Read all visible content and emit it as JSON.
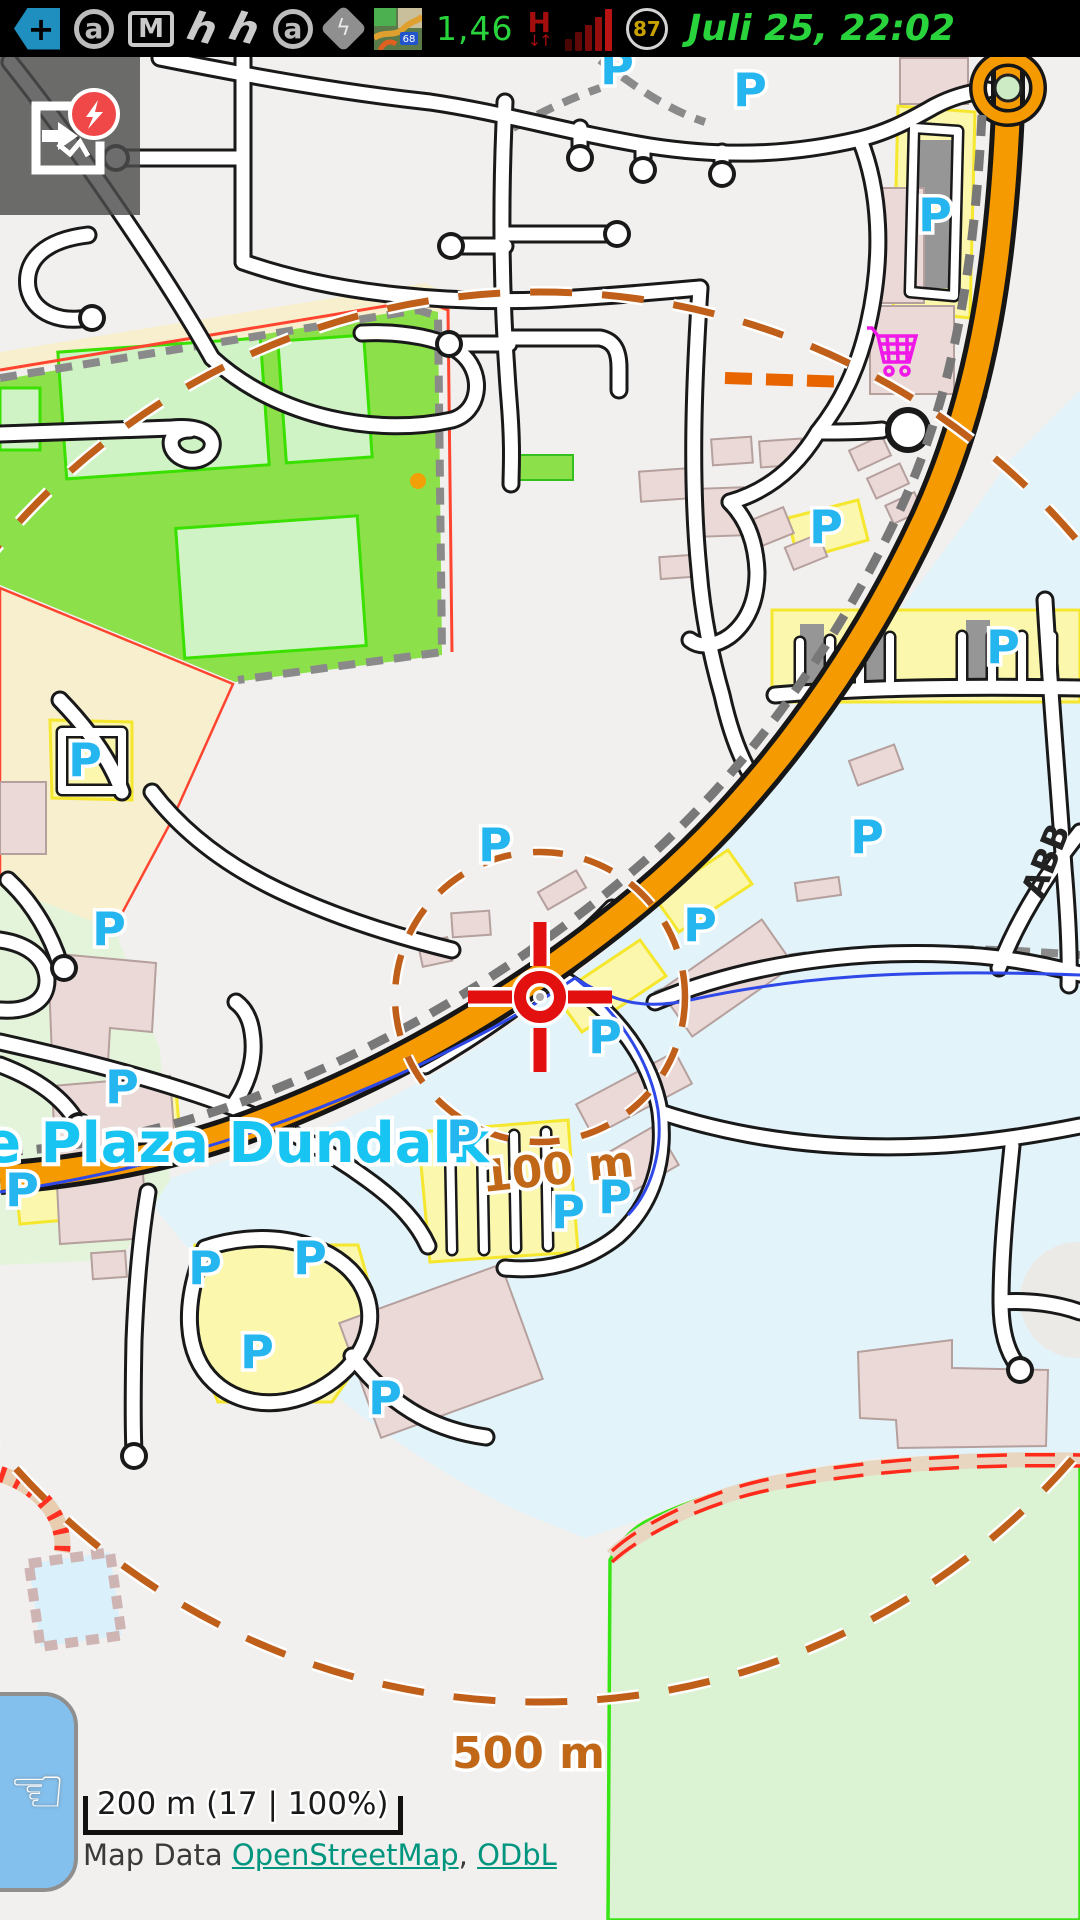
{
  "status_bar": {
    "icons": [
      "back-arrow-plus",
      "app-circle-a",
      "gmail",
      "app-h",
      "app-h-2",
      "app-circle-a-2",
      "navigation-diamond",
      "minimap"
    ],
    "data_value": "1,46",
    "network_mode": "H",
    "battery_percent": "87",
    "datetime": "Juli 25, 22:02"
  },
  "map": {
    "place_label": "The Plaza Dundalk",
    "ring_100": "100 m",
    "ring_500": "500 m",
    "street_label": "ABB",
    "parking_symbol": "P",
    "parking_markers": [
      [
        617,
        68
      ],
      [
        750,
        90
      ],
      [
        935,
        215
      ],
      [
        826,
        527
      ],
      [
        1003,
        647
      ],
      [
        85,
        760
      ],
      [
        867,
        837
      ],
      [
        495,
        845
      ],
      [
        700,
        925
      ],
      [
        109,
        929
      ],
      [
        605,
        1037
      ],
      [
        122,
        1087
      ],
      [
        463,
        1137
      ],
      [
        22,
        1190
      ],
      [
        615,
        1197
      ],
      [
        568,
        1212
      ],
      [
        205,
        1268
      ],
      [
        310,
        1258
      ],
      [
        257,
        1352
      ],
      [
        385,
        1398
      ]
    ],
    "colors": {
      "accent_cyan": "#25b6ef",
      "trunk_orange": "#f59a00",
      "ring_orange": "#bf5f1a",
      "park_green": "#8ce04a",
      "commercial_blue": "#e2f3fa",
      "building_pink": "#ead9d6",
      "parking_yellow": "#fbf7ac",
      "crosshair_red": "#e31010",
      "cart_magenta": "#f018e8"
    }
  },
  "overlays": {
    "scale_text": "200 m (17 | 100%)",
    "attribution_prefix": "Map Data ",
    "attribution_link1": "OpenStreetMap",
    "attribution_sep": ", ",
    "attribution_link2": "ODbL"
  }
}
